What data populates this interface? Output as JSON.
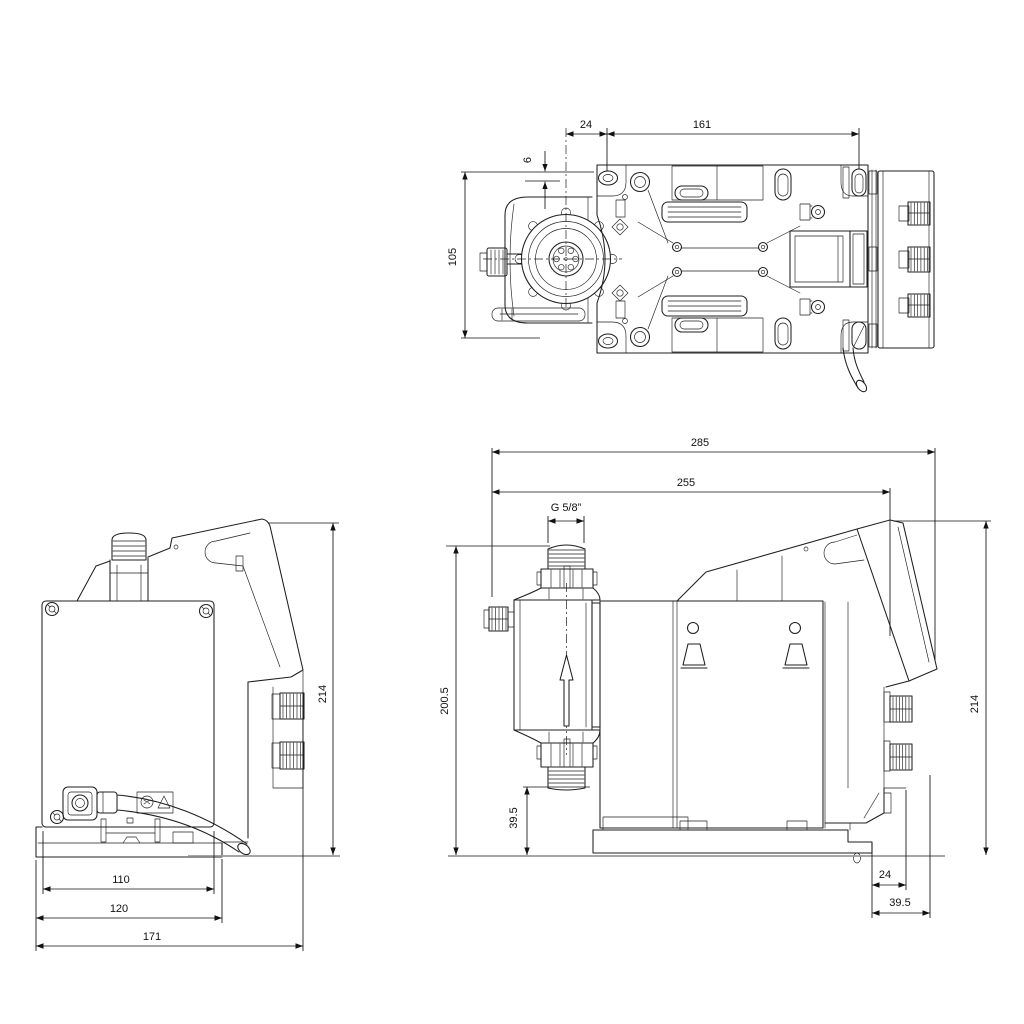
{
  "drawing": {
    "type": "technical-dimension-drawing",
    "subject": "diaphragm dosing pump, three orthographic views",
    "units": "mm",
    "colors": {
      "line": "#1f1f1f",
      "dim_text": "#111111",
      "baseline": "#9a9a9a",
      "background": "#ffffff"
    },
    "views": {
      "top": {
        "label": "top view",
        "dims": {
          "head_center_to_slot": "24",
          "slot_span": "161",
          "edge_to_slot": "6",
          "plate_height": "105"
        }
      },
      "back": {
        "label": "back view",
        "dims": {
          "plate_width": "110",
          "base_width": "120",
          "overall_width": "171",
          "overall_height": "214"
        }
      },
      "side": {
        "label": "side view",
        "dims": {
          "overall_length": "285",
          "length_to_panel": "255",
          "thread": "G 5/8”",
          "inlet_height": "200.5",
          "valve_clearance": "39.5",
          "overall_height": "214",
          "foot_offset": "24",
          "rear_clearance": "39.5"
        }
      }
    }
  }
}
